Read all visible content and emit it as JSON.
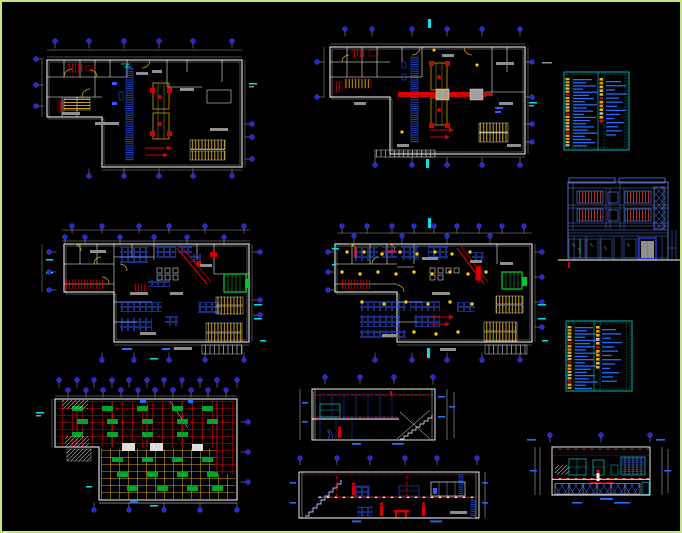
{
  "sheet": {
    "width": 682,
    "height": 533,
    "background": "#000000",
    "frame_color": "#c6e87a"
  },
  "palette": {
    "wall_white": "#ffffff",
    "dim_gray": "#8f8f8f",
    "cad_blue": "#2d5cff",
    "text_blue": "#1e6fff",
    "bubble_blue": "#2326e0",
    "teal_border": "#00b4b4",
    "bright_cyan": "#00e5e5",
    "elevation_blue": "#5578d8",
    "red": "#d40000",
    "window_red": "#c03030",
    "yellow": "#e3b505",
    "lamp_yellow": "#ffd200",
    "green": "#00a428",
    "machine_green": "#00c832"
  },
  "panels": [
    {
      "id": "plan1",
      "name": "floor-plan-top-left"
    },
    {
      "id": "plan2",
      "name": "floor-plan-top-middle"
    },
    {
      "id": "legend1",
      "name": "legend-schedule-table-upper-right"
    },
    {
      "id": "elevation",
      "name": "building-elevation-right"
    },
    {
      "id": "plan3",
      "name": "floor-plan-middle-left"
    },
    {
      "id": "plan4",
      "name": "floor-plan-middle-center"
    },
    {
      "id": "legend2",
      "name": "legend-schedule-table-right"
    },
    {
      "id": "plan5",
      "name": "ceiling-plan-bottom-left"
    },
    {
      "id": "sec1",
      "name": "building-section-upper"
    },
    {
      "id": "sec2",
      "name": "building-section-lower"
    },
    {
      "id": "sec3",
      "name": "interior-section-bottom-right"
    }
  ],
  "grid_bubbles": {
    "plan1": [
      {
        "side": "top",
        "fixed": 39,
        "coords": [
          53,
          87,
          122,
          157,
          191,
          230
        ]
      },
      {
        "side": "bottom",
        "fixed": 174,
        "coords": [
          87,
          122,
          157,
          191,
          230
        ]
      },
      {
        "side": "left",
        "fixed": 34,
        "coords": [
          57,
          83,
          104
        ]
      },
      {
        "side": "right",
        "fixed": 250,
        "coords": [
          122,
          135,
          157
        ]
      }
    ],
    "plan2": [
      {
        "side": "top",
        "fixed": 27,
        "coords": [
          343,
          370,
          410,
          445,
          480,
          518
        ]
      },
      {
        "side": "bottom",
        "fixed": 163,
        "coords": [
          373,
          410,
          445,
          480,
          518
        ]
      },
      {
        "side": "left",
        "fixed": 315,
        "coords": [
          60,
          95
        ]
      },
      {
        "side": "right",
        "fixed": 530,
        "coords": [
          60,
          95,
          122,
          140
        ]
      }
    ],
    "plan3": [
      {
        "side": "top",
        "fixed": 224,
        "coords": [
          70,
          100,
          137,
          167,
          203,
          242
        ]
      },
      {
        "side": "top",
        "fixed": 235,
        "coords": [
          63,
          83,
          118,
          152,
          185,
          222
        ]
      },
      {
        "side": "bottom",
        "fixed": 358,
        "coords": [
          100,
          132,
          167,
          203,
          242
        ]
      },
      {
        "side": "left",
        "fixed": 47,
        "coords": [
          250,
          270,
          288
        ]
      },
      {
        "side": "right",
        "fixed": 258,
        "coords": [
          250,
          298,
          313
        ]
      }
    ],
    "plan4": [
      {
        "side": "top",
        "fixed": 224,
        "coords": [
          340,
          365,
          390,
          412,
          432,
          455,
          477,
          500,
          522
        ]
      },
      {
        "side": "top",
        "fixed": 234,
        "coords": [
          352,
          400,
          445,
          488
        ]
      },
      {
        "side": "bottom",
        "fixed": 358,
        "coords": [
          373,
          410,
          445,
          480,
          518
        ]
      },
      {
        "side": "left",
        "fixed": 326,
        "coords": [
          250,
          270,
          288
        ]
      },
      {
        "side": "right",
        "fixed": 540,
        "coords": [
          250,
          275,
          300,
          325
        ]
      }
    ],
    "plan5": [
      {
        "side": "top",
        "fixed": 378,
        "coords": [
          57,
          75,
          92,
          110,
          127,
          145,
          162,
          180,
          198,
          215,
          235
        ]
      },
      {
        "side": "top",
        "fixed": 388,
        "coords": [
          66,
          84,
          101,
          119,
          136,
          153,
          171,
          189,
          206,
          224
        ]
      },
      {
        "side": "bottom",
        "fixed": 508,
        "coords": [
          92,
          127,
          162,
          198,
          235
        ]
      },
      {
        "side": "right",
        "fixed": 246,
        "coords": [
          420,
          450,
          480
        ]
      }
    ],
    "sec1": [
      {
        "side": "top",
        "fixed": 375,
        "coords": [
          323,
          358,
          392,
          431
        ]
      }
    ],
    "sec2": [
      {
        "side": "top",
        "fixed": 456,
        "coords": [
          298,
          335,
          368,
          403,
          435,
          475
        ]
      }
    ],
    "sec3": [
      {
        "side": "top",
        "fixed": 433,
        "coords": [
          548,
          599,
          648
        ]
      }
    ]
  },
  "legend_tables": [
    {
      "key": "t1",
      "x": 562,
      "y": 70,
      "w": 65,
      "h": 78,
      "left_text": {
        "x": 571,
        "y0": 77,
        "step": 3.15,
        "widths": [
          19,
          13,
          23,
          10,
          25,
          16,
          21,
          12,
          24,
          14,
          20,
          11,
          23,
          17,
          13,
          21,
          15,
          24,
          12,
          18,
          22,
          14
        ]
      },
      "right_text": {
        "x": 604,
        "y0": 79,
        "step": 4.1,
        "widths": [
          15,
          20,
          9,
          21,
          13,
          17,
          11,
          20,
          14,
          8,
          18,
          12,
          16,
          10
        ]
      },
      "left_sym": {
        "x": 563.5,
        "y0": 76,
        "step": 3.15,
        "n": 22
      },
      "mid_sym": {
        "x": 597.5,
        "y0": 76,
        "step": 3.8,
        "n": 12
      }
    },
    {
      "key": "t2",
      "x": 564,
      "y": 319,
      "w": 66,
      "h": 70,
      "left_text": {
        "x": 573,
        "y0": 325,
        "step": 3.2,
        "widths": [
          18,
          12,
          22,
          10,
          24,
          15,
          20,
          11,
          23,
          13,
          19,
          10,
          22,
          16,
          12,
          20,
          14,
          23,
          11,
          17
        ]
      },
      "right_text": {
        "x": 600,
        "y0": 327,
        "step": 4.3,
        "widths": [
          14,
          19,
          9,
          20,
          12,
          16,
          10,
          19,
          13,
          8,
          17,
          11,
          15
        ]
      },
      "left_sym": {
        "x": 565.5,
        "y0": 324,
        "step": 3.2,
        "n": 20
      },
      "mid_sym": {
        "x": 594,
        "y0": 324,
        "step": 4.0,
        "n": 11
      }
    }
  ],
  "symbol_colors": [
    "#e3b505",
    "#ff8c00",
    "#e3b505",
    "#bbbbbb",
    "#e3b505",
    "#d40000"
  ],
  "plan4_lamps": [
    [
      345,
      250
    ],
    [
      362,
      250
    ],
    [
      380,
      252
    ],
    [
      398,
      250
    ],
    [
      415,
      252
    ],
    [
      433,
      250
    ],
    [
      450,
      252
    ],
    [
      468,
      250
    ],
    [
      340,
      270
    ],
    [
      358,
      272
    ],
    [
      376,
      270
    ],
    [
      394,
      272
    ],
    [
      412,
      270
    ],
    [
      430,
      272
    ],
    [
      448,
      270
    ],
    [
      466,
      272
    ],
    [
      484,
      270
    ],
    [
      360,
      300
    ],
    [
      382,
      302
    ],
    [
      404,
      300
    ],
    [
      426,
      302
    ],
    [
      448,
      300
    ],
    [
      470,
      302
    ],
    [
      412,
      330
    ],
    [
      434,
      332
    ],
    [
      456,
      330
    ]
  ],
  "plan5_fixtures": {
    "size": [
      11,
      5
    ],
    "red_zone": [
      [
        70,
        404
      ],
      [
        100,
        404
      ],
      [
        135,
        404
      ],
      [
        170,
        404
      ],
      [
        200,
        404
      ],
      [
        75,
        417
      ],
      [
        105,
        417
      ],
      [
        140,
        417
      ],
      [
        175,
        417
      ],
      [
        205,
        417
      ],
      [
        70,
        430
      ],
      [
        105,
        430
      ],
      [
        140,
        430
      ],
      [
        175,
        430
      ]
    ],
    "yellow_zone": [
      [
        110,
        455
      ],
      [
        140,
        455
      ],
      [
        170,
        455
      ],
      [
        200,
        455
      ],
      [
        115,
        470
      ],
      [
        145,
        470
      ],
      [
        175,
        470
      ],
      [
        205,
        470
      ],
      [
        125,
        484
      ],
      [
        155,
        484
      ],
      [
        185,
        484
      ],
      [
        210,
        484
      ]
    ]
  }
}
